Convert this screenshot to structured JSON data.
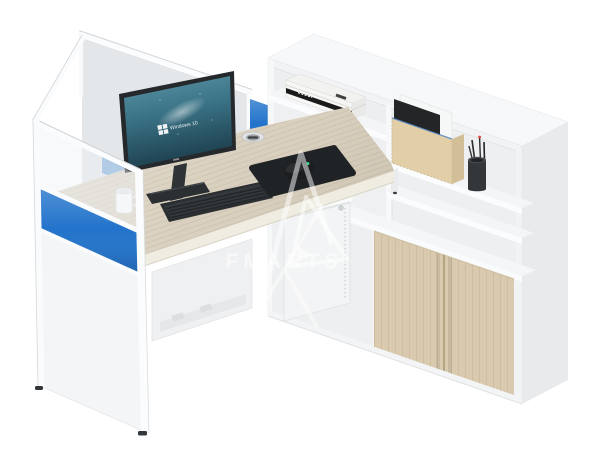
{
  "image": {
    "background": "#ffffff"
  },
  "watermark": {
    "text": "FMARTS"
  },
  "monitor": {
    "screen_text": "Windows 10"
  },
  "colors": {
    "panel_blue": "#2273cb",
    "desk_wood": "#d8cebc",
    "door_wood": "#dacbb0",
    "plywood_box": "#e2cfa8",
    "cabinet_white": "#f2f3f4",
    "device_dark": "#2b2e31",
    "screen_teal_top": "#5d96a6",
    "screen_teal_bottom": "#1d3f4e",
    "frame_white": "#fafbfc"
  }
}
